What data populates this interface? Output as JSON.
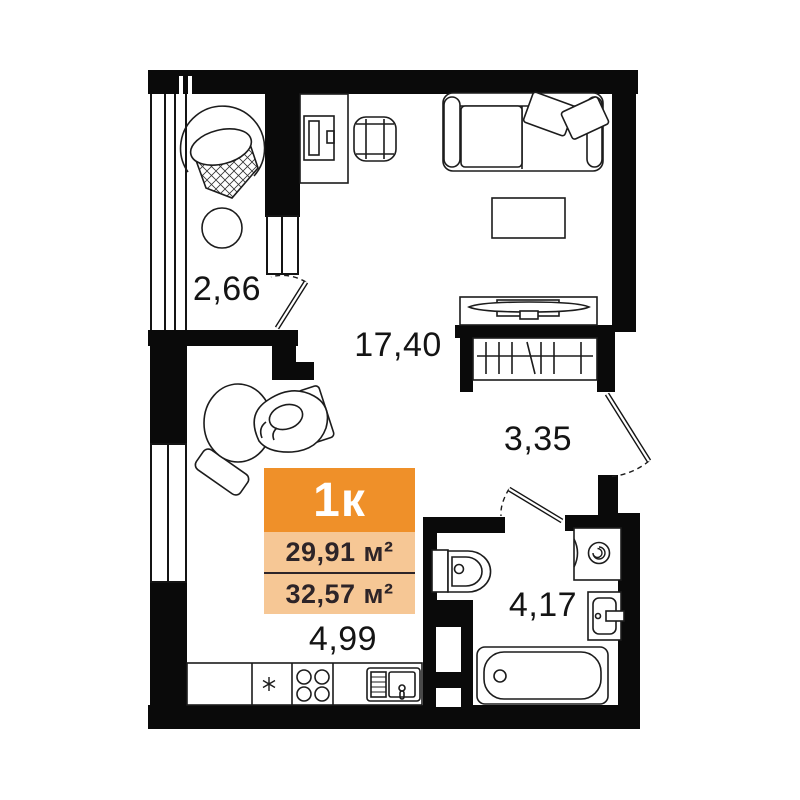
{
  "plan": {
    "title": "1-room apartment floor plan",
    "wall_color": "#0a0a0a",
    "line_color": "#1c1c1c",
    "rooms": {
      "balcony": {
        "area": "2,66"
      },
      "living_room": {
        "area": "17,40"
      },
      "hallway": {
        "area": "3,35"
      },
      "bathroom": {
        "area": "4,17"
      },
      "kitchen": {
        "area": "4,99"
      }
    },
    "unit_badge": {
      "type": "1к",
      "living_area": "29,91 м²",
      "total_area": "32,57 м²",
      "header_bg": "#ef9029",
      "body_bg": "#f6c795"
    },
    "furniture_icons": [
      "hanging-chair",
      "balcony-table",
      "desk",
      "office-chair",
      "sofa",
      "coffee-table",
      "tv-stand",
      "wardrobe",
      "round-bed",
      "kitchen-counter",
      "fridge",
      "stove",
      "kitchen-sink",
      "toilet",
      "washing-machine",
      "bathroom-sink",
      "bathtub",
      "vent-shaft",
      "balcony-door",
      "entrance-door",
      "bathroom-door"
    ]
  }
}
